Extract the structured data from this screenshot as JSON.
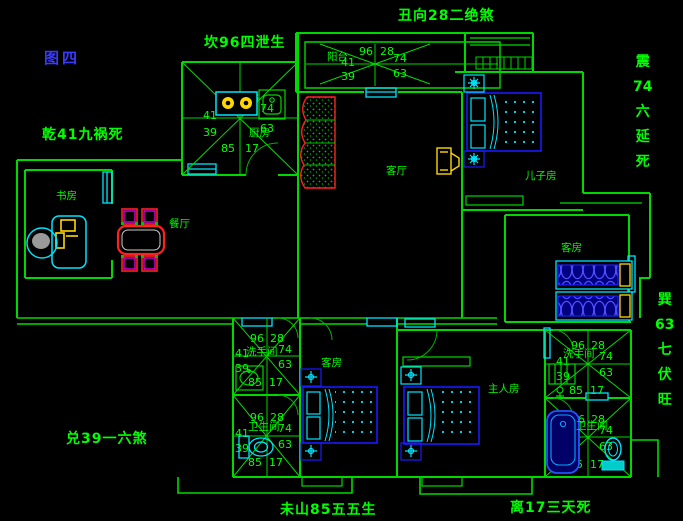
{
  "figure_label": "图四",
  "annotations": {
    "kan": "坎96四泄生",
    "chou": "丑向28二绝煞",
    "qian": "乾41九祸死",
    "dui": "兑39一六煞",
    "wei": "未山85五五生",
    "li": "离17三天死",
    "zhen": [
      "震",
      "74",
      "六",
      "延",
      "死"
    ],
    "xun": [
      "巽",
      "63",
      "七",
      "伏",
      "旺"
    ]
  },
  "rooms": {
    "kitchen": "厨房",
    "balcony": "阳台",
    "living": "客厅",
    "dining": "餐厅",
    "study": "书房",
    "son": "儿子房",
    "guest_right": "客房",
    "guest_bottom": "客房",
    "master": "主人房",
    "wash_left": "洗手间",
    "toilet_left": "卫生间",
    "wash_right": "洗手间",
    "toilet_right": "卫生间"
  },
  "compass": {
    "n96": "96",
    "n28": "28",
    "n41": "41",
    "n74": "74",
    "n39": "39",
    "n63": "63",
    "n85": "85",
    "n17": "17"
  },
  "colors": {
    "wall": "#00d900",
    "text": "#00ff00",
    "figure_label": "#3a3aff",
    "window": "#00e5ff",
    "furniture_blue": "#1a1aff",
    "accent_yellow": "#ffd700",
    "accent_red": "#ff2020",
    "accent_magenta": "#ff00ff"
  }
}
